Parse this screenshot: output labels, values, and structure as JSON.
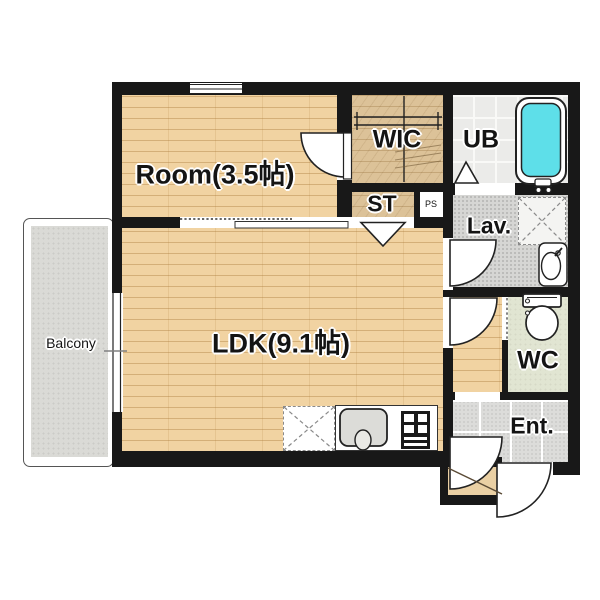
{
  "plan": {
    "labels": {
      "room": "Room(3.5帖)",
      "ldk": "LDK(9.1帖)",
      "wic": "WIC",
      "ub": "UB",
      "st": "ST",
      "ps": "PS",
      "lav": "Lav.",
      "wc": "WC",
      "ent": "Ent.",
      "balcony": "Balcony"
    },
    "fixtures": [
      "bathtub",
      "toilet",
      "lavatory-sink",
      "washing-machine-space",
      "kitchen-sink",
      "gas-stove",
      "refrigerator-space",
      "closet-rod",
      "entry-step"
    ],
    "colors": {
      "wall": "#181818",
      "wood_floor": "#f1d3a2",
      "wic_floor": "#dcc298",
      "bathtub_water": "#5edfe9",
      "wc_floor": "#e1e5d2",
      "balcony_floor": "#dadad6",
      "entrance_tile": "#dcdcda",
      "lav_floor": "#d6d6d4",
      "ub_tile": "#ebebe9"
    }
  }
}
